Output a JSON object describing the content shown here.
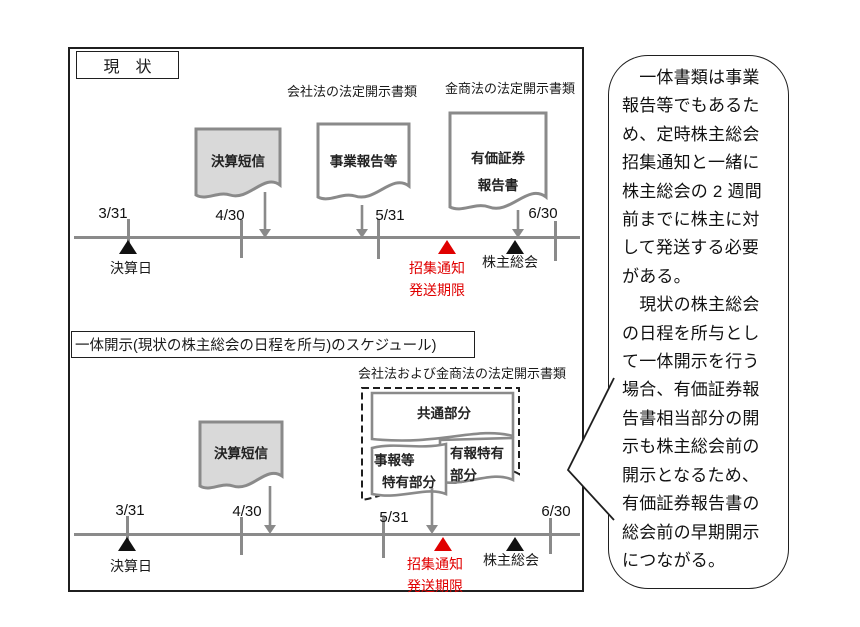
{
  "colors": {
    "accent_red": "#e00000",
    "shape_gray": "#8a8a8a",
    "doc_fill_gray": "#d9d9d9",
    "frame_black": "#1f1f1f"
  },
  "current": {
    "title": "現　状",
    "company_law_label": "会社法の法定開示書類",
    "fiea_label": "金商法の法定開示書類",
    "doc_kessan": "決算短信",
    "doc_jigyo": "事業報告等",
    "doc_yuho_l1": "有価証券",
    "doc_yuho_l2": "報告書",
    "dates": [
      "3/31",
      "4/30",
      "5/31",
      "6/30"
    ],
    "settlement_day": "決算日",
    "notice_l1": "招集通知",
    "notice_l2": "発送期限",
    "agm": "株主総会"
  },
  "integrated": {
    "heading": "一体開示(現状の株主総会の日程を所与)のスケジュール)",
    "combined_law_label": "会社法および金商法の法定開示書類",
    "doc_kessan": "決算短信",
    "doc_common": "共通部分",
    "doc_jihou_l1": "事報等",
    "doc_jihou_l2": "特有部分",
    "doc_yuho_l1": "有報特有",
    "doc_yuho_l2": "部分",
    "dates": [
      "3/31",
      "4/30",
      "5/31",
      "6/30"
    ],
    "settlement_day": "決算日",
    "notice_l1": "招集通知",
    "notice_l2": "発送期限",
    "agm": "株主総会"
  },
  "callout": {
    "para1": "　一体書類は事業報告等でもあるため、定時株主総会招集通知と一緒に株主総会の 2 週間前までに株主に対して発送する必要がある。",
    "para2": "　現状の株主総会の日程を所与として一体開示を行う場合、有価証券報告書相当部分の開示も株主総会前の開示となるため、有価証券報告書の総会前の早期開示につながる。"
  }
}
